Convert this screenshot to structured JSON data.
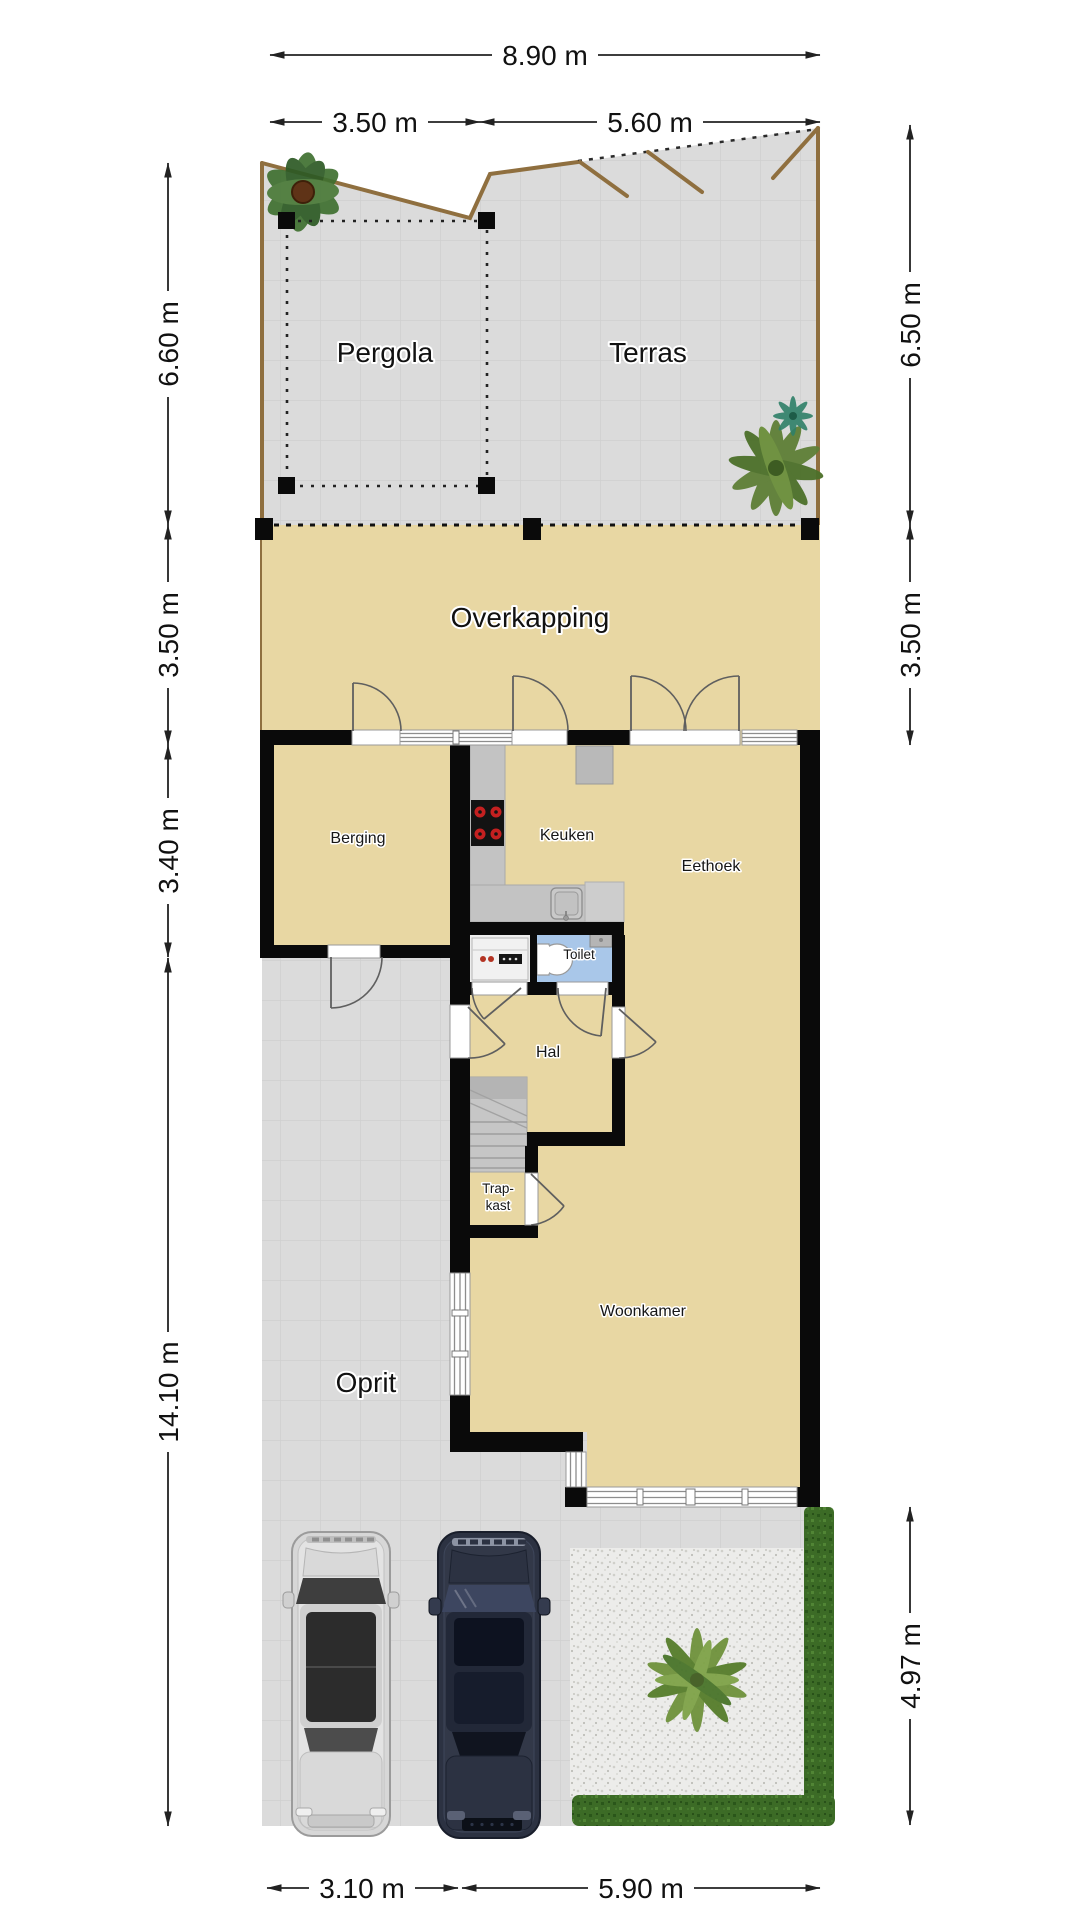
{
  "floorplan": {
    "rooms": {
      "pergola": "Pergola",
      "terras": "Terras",
      "overkapping": "Overkapping",
      "berging": "Berging",
      "keuken": "Keuken",
      "eethoek": "Eethoek",
      "toilet": "Toilet",
      "hal": "Hal",
      "trapkast_line1": "Trap-",
      "trapkast_line2": "kast",
      "woonkamer": "Woonkamer",
      "oprit": "Oprit"
    },
    "dimensions": {
      "top_total": "8.90 m",
      "top_left": "3.50 m",
      "top_right": "5.60 m",
      "left_garden": "6.60 m",
      "left_overkapping": "3.50 m",
      "left_storage": "3.40 m",
      "left_driveway": "14.10 m",
      "right_garden": "6.50 m",
      "right_overkapping": "3.50 m",
      "right_garden_bottom": "4.97 m",
      "bottom_driveway": "3.10 m",
      "bottom_house": "5.90 m"
    },
    "colors": {
      "wall": "#0a0a0a",
      "floor": "#e8d7a3",
      "paving": "#dbdbdb",
      "gravel": "#ececea",
      "hedge": "#3c6b26",
      "toilet_floor": "#a9c7e9",
      "fence": "#8f6f3f"
    }
  }
}
